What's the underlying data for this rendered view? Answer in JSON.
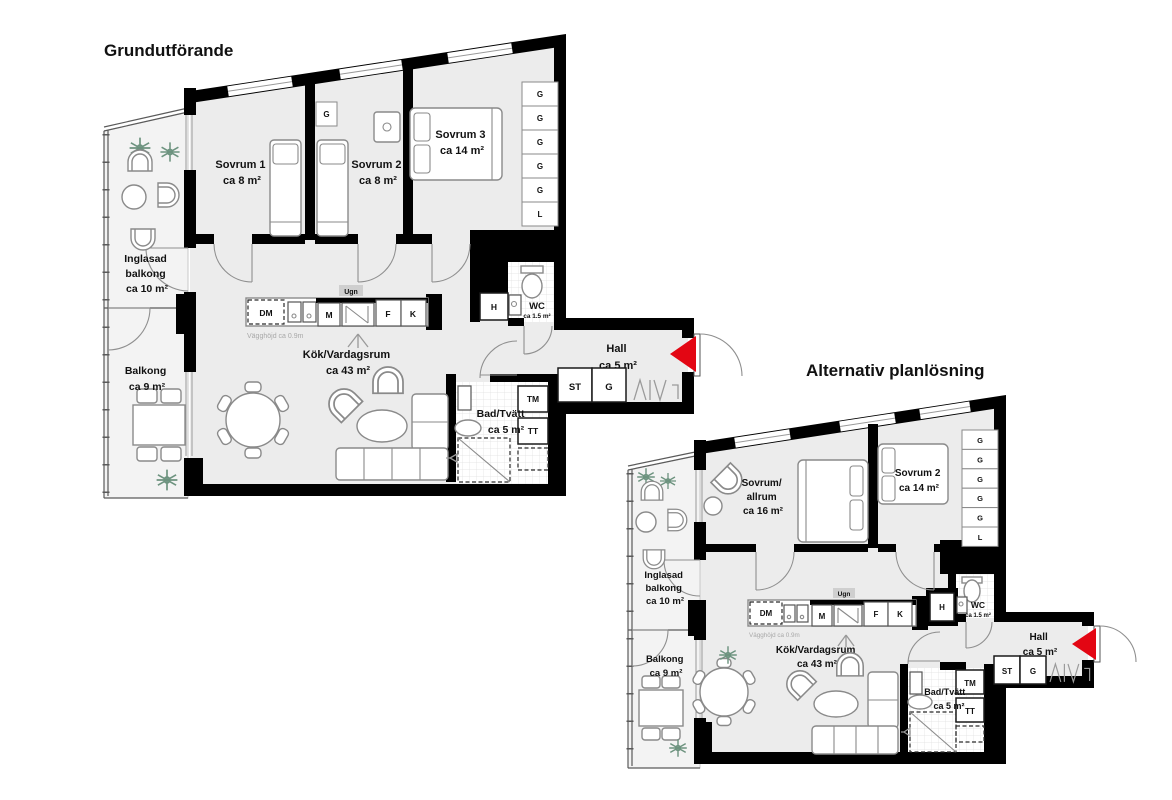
{
  "colors": {
    "wall": "#000000",
    "entry_arrow": "#e30613",
    "floor": "#ececec",
    "balcony_floor": "#f3f3f3",
    "plant": "#6d937f"
  },
  "plans": [
    {
      "title": "Grundutförande",
      "rooms": {
        "sovrum1": {
          "lines": [
            "Sovrum 1",
            "ca 8 m²"
          ]
        },
        "sovrum2": {
          "lines": [
            "Sovrum 2",
            "ca 8 m²"
          ]
        },
        "sovrum3": {
          "lines": [
            "Sovrum 3",
            "ca 14 m²"
          ]
        },
        "inglasad_balkong": {
          "lines": [
            "Inglasad",
            "balkong",
            "ca 10 m²"
          ]
        },
        "balkong": {
          "lines": [
            "Balkong",
            "ca 9 m²"
          ]
        },
        "kok_vardagsrum": {
          "lines": [
            "Kök/Vardagsrum",
            "ca 43 m²"
          ]
        },
        "bad_tvatt": {
          "lines": [
            "Bad/Tvätt",
            "ca 5 m²"
          ]
        },
        "hall": {
          "lines": [
            "Hall",
            "ca 5 m²"
          ]
        },
        "wc": {
          "lines": [
            "WC",
            "ca 1.5 m²"
          ]
        }
      },
      "kitchen": {
        "dm": "DM",
        "m": "M",
        "ugn": "Ugn",
        "f": "F",
        "k": "K",
        "wall_height_note": "Vägghöjd ca 0.9m"
      },
      "storage": {
        "h": "H",
        "st": "ST",
        "g": "G",
        "tm": "TM",
        "tt": "TT",
        "bedroom_wardrobe": "G",
        "closet_column": [
          "G",
          "G",
          "G",
          "G",
          "G",
          "L"
        ]
      }
    },
    {
      "title": "Alternativ planlösning",
      "rooms": {
        "sovrum_allrum": {
          "lines": [
            "Sovrum/",
            "allrum",
            "ca 16 m²"
          ]
        },
        "sovrum2": {
          "lines": [
            "Sovrum 2",
            "ca 14 m²"
          ]
        },
        "inglasad_balkong": {
          "lines": [
            "Inglasad",
            "balkong",
            "ca 10 m²"
          ]
        },
        "balkong": {
          "lines": [
            "Balkong",
            "ca 9 m²"
          ]
        },
        "kok_vardagsrum": {
          "lines": [
            "Kök/Vardagsrum",
            "ca 43 m²"
          ]
        },
        "bad_tvatt": {
          "lines": [
            "Bad/Tvätt",
            "ca 5 m²"
          ]
        },
        "hall": {
          "lines": [
            "Hall",
            "ca 5 m²"
          ]
        },
        "wc": {
          "lines": [
            "WC",
            "ca 1.5 m²"
          ]
        }
      },
      "kitchen": {
        "dm": "DM",
        "m": "M",
        "ugn": "Ugn",
        "f": "F",
        "k": "K",
        "wall_height_note": "Vägghöjd ca 0.9m"
      },
      "storage": {
        "h": "H",
        "st": "ST",
        "g": "G",
        "tm": "TM",
        "tt": "TT",
        "closet_column": [
          "G",
          "G",
          "G",
          "G",
          "G",
          "L"
        ]
      }
    }
  ]
}
